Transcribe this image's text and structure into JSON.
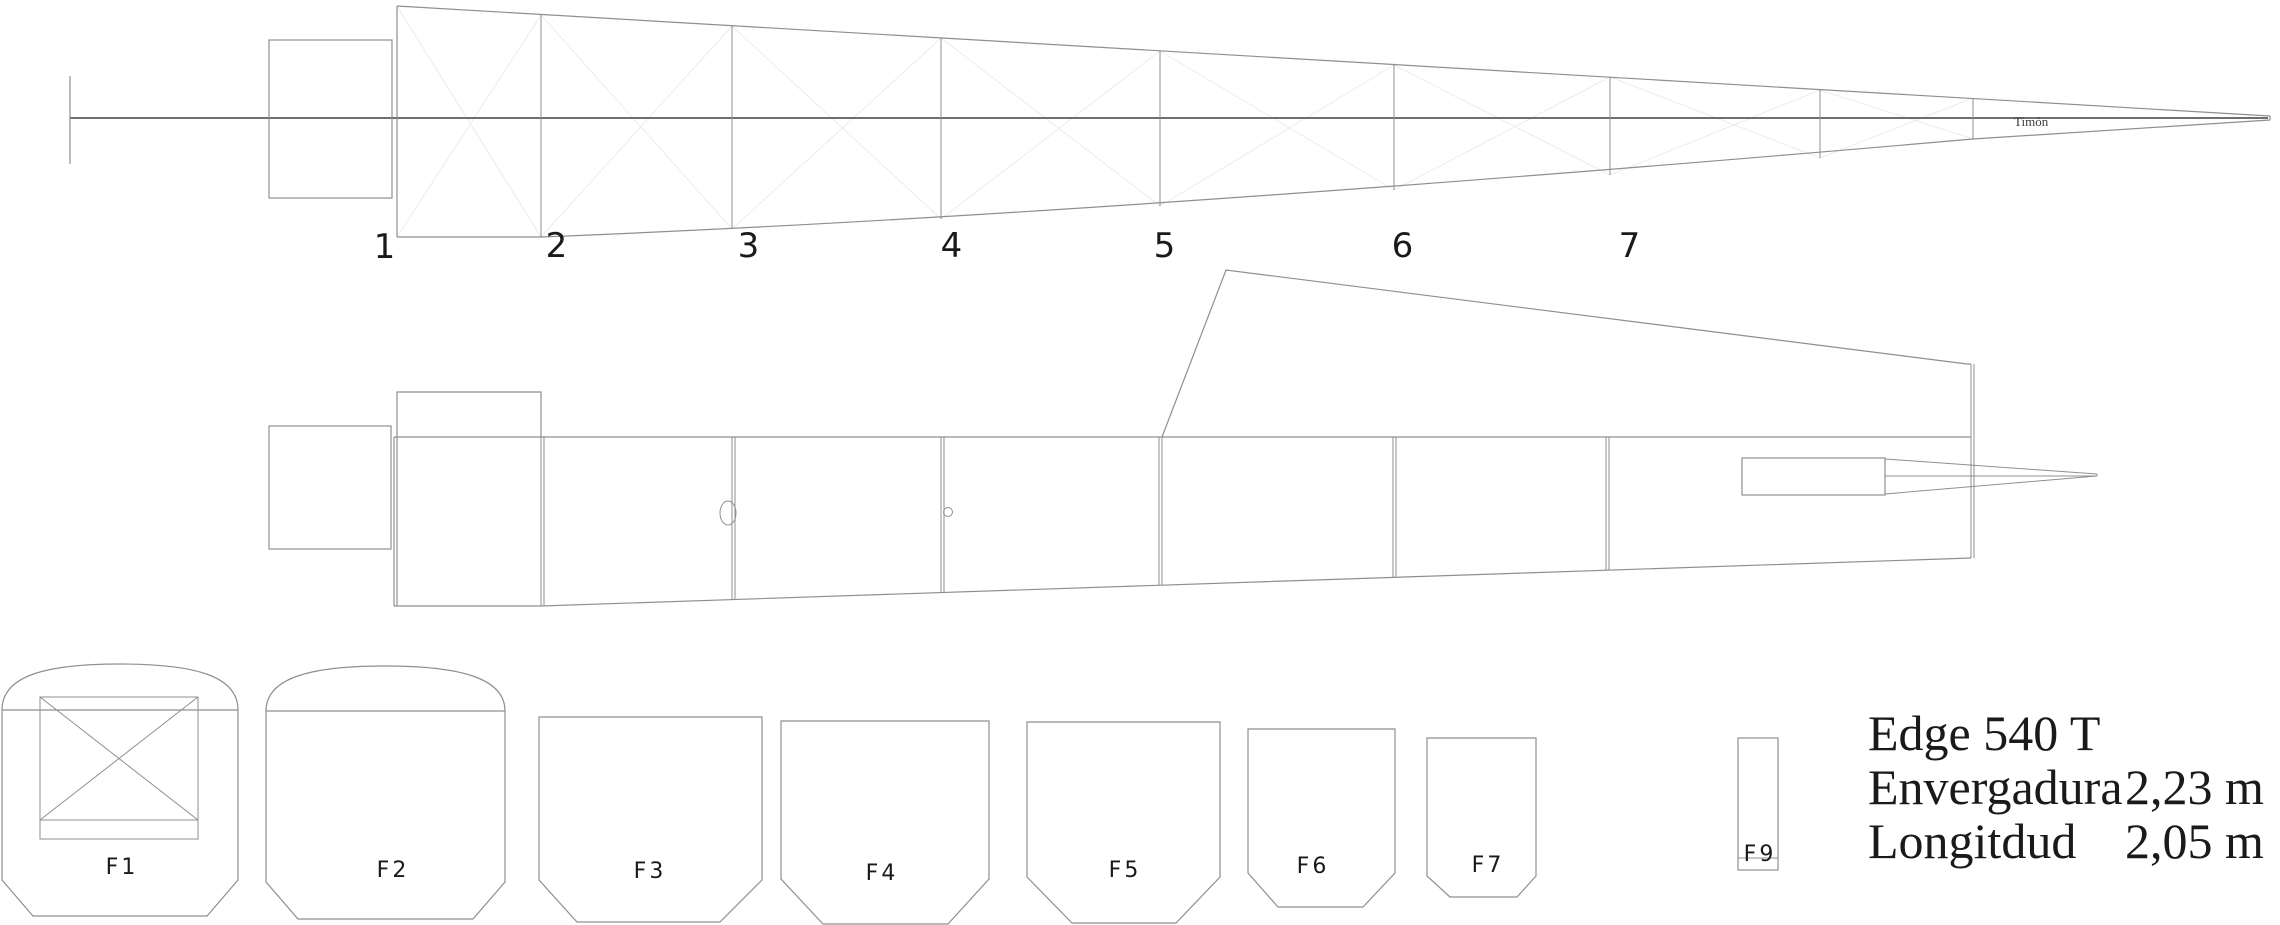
{
  "title_block": {
    "model": "Edge 540 T",
    "spec1_label": "Envergadura",
    "spec1_value": "2,23 m",
    "spec2_label": "Longitdud",
    "spec2_value": "2,05 m"
  },
  "top_view": {
    "station_labels": [
      "1",
      "2",
      "3",
      "4",
      "5",
      "6",
      "7"
    ],
    "rudder_label": "Timón"
  },
  "formers": {
    "labels": [
      "F1",
      "F2",
      "F3",
      "F4",
      "F5",
      "F6",
      "F7",
      "F9"
    ]
  },
  "colors": {
    "line": "#8f8f8f",
    "centerline": "#6f6f6f",
    "faint": "#ececec",
    "text": "#1a1a1a"
  }
}
